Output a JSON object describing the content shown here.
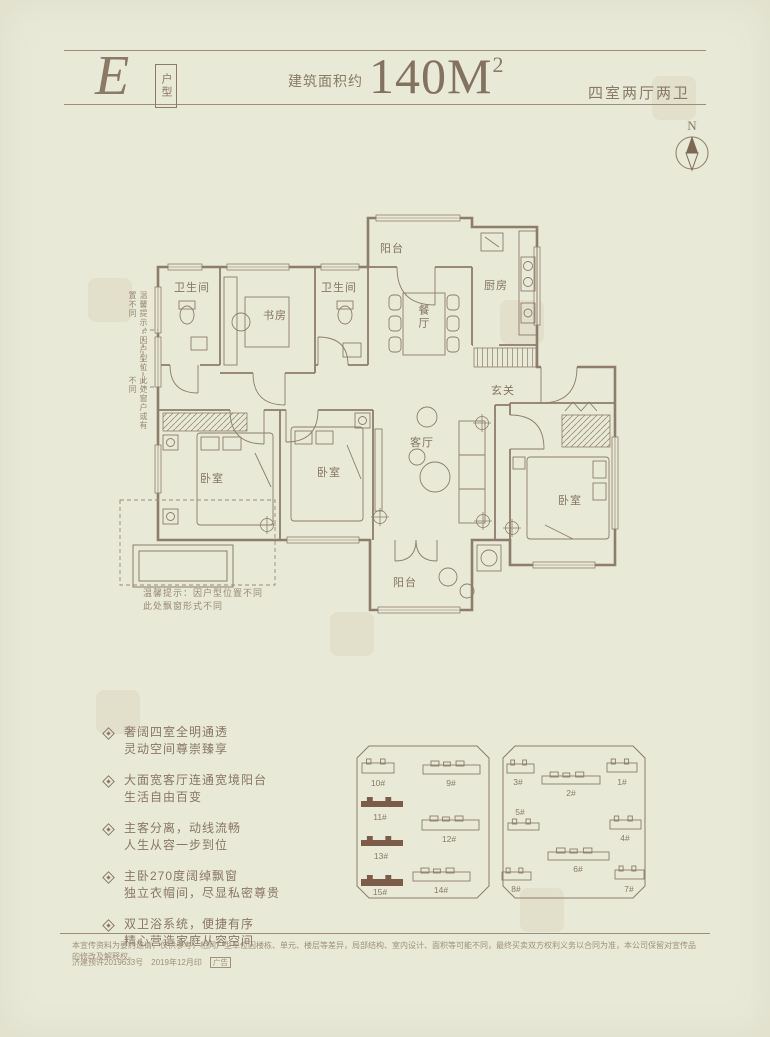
{
  "page": {
    "colors": {
      "background": "#e8e9d7",
      "ink": "#8a7a66",
      "wall": "#8d7d6a",
      "highlight_fill": "#7c5c49"
    }
  },
  "header": {
    "unit_letter": "E",
    "unit_label": "户型",
    "area_prefix": "建筑面积约",
    "area_number": "140M",
    "area_sup": "2",
    "spec": "四室两厅两卫",
    "compass_n": "N"
  },
  "floorplan": {
    "labels": {
      "bath1": "卫生间",
      "study": "书房",
      "bath2": "卫生间",
      "balcony_top": "阳台",
      "dining": "餐厅",
      "kitchen": "厨房",
      "foyer": "玄关",
      "living": "客厅",
      "bed1": "卧室",
      "bed2": "卧室",
      "bed3": "卧室",
      "balcony_bottom": "阳台"
    },
    "side_note_col1": "温馨提示：因户型位置不同",
    "side_note_col2": "此处窗户或有不同",
    "corner_note_line1": "温馨提示：因户型位置不同",
    "corner_note_line2": "此处飘窗形式不同"
  },
  "features": [
    {
      "line1": "奢阔四室全明通透",
      "line2": "灵动空间尊崇臻享"
    },
    {
      "line1": "大面宽客厅连通宽境阳台",
      "line2": "生活自由百变"
    },
    {
      "line1": "主客分离，动线流畅",
      "line2": "人生从容一步到位"
    },
    {
      "line1": "主卧270度阔绰飘窗",
      "line2": "独立衣帽间，尽显私密尊贵"
    },
    {
      "line1": "双卫浴系统，便捷有序",
      "line2": "精心营造家庭从容空间"
    }
  ],
  "siteplan": {
    "highlighted": [
      "11#",
      "13#",
      "15#"
    ],
    "left_block": {
      "outline": "M16 4 L124 4 L136 16 L136 144 L124 156 L16 156 L4 144 L4 16 Z",
      "buildings": [
        {
          "label": "10#",
          "x": 9,
          "y": 17,
          "w": 32,
          "h": 14,
          "filled": false,
          "lx": 25,
          "ly": 44
        },
        {
          "label": "9#",
          "x": 70,
          "y": 19,
          "w": 57,
          "h": 13,
          "filled": false,
          "lx": 98,
          "ly": 44
        },
        {
          "label": "11#",
          "x": 8,
          "y": 55,
          "w": 42,
          "h": 10,
          "filled": true,
          "lx": 27,
          "ly": 78
        },
        {
          "label": "12#",
          "x": 69,
          "y": 74,
          "w": 57,
          "h": 14,
          "filled": false,
          "lx": 96,
          "ly": 100
        },
        {
          "label": "13#",
          "x": 8,
          "y": 94,
          "w": 42,
          "h": 10,
          "filled": true,
          "lx": 28,
          "ly": 117
        },
        {
          "label": "14#",
          "x": 60,
          "y": 126,
          "w": 57,
          "h": 13,
          "filled": false,
          "lx": 88,
          "ly": 151
        },
        {
          "label": "15#",
          "x": 8,
          "y": 133,
          "w": 42,
          "h": 11,
          "filled": true,
          "lx": 27,
          "ly": 153
        }
      ]
    },
    "right_block": {
      "outline": "M18 4 H136 L148 16 V144 L136 156 H18 L6 144 V16 Z",
      "buildings": [
        {
          "label": "3#",
          "x": 10,
          "y": 18,
          "w": 27,
          "h": 13,
          "filled": false,
          "lx": 21,
          "ly": 43
        },
        {
          "label": "2#",
          "x": 45,
          "y": 30,
          "w": 58,
          "h": 12,
          "filled": false,
          "lx": 74,
          "ly": 54
        },
        {
          "label": "1#",
          "x": 110,
          "y": 17,
          "w": 30,
          "h": 13,
          "filled": false,
          "lx": 125,
          "ly": 43
        },
        {
          "label": "5#",
          "x": 11,
          "y": 77,
          "w": 31,
          "h": 11,
          "filled": false,
          "lx": 23,
          "ly": 73,
          "labelAbove": true
        },
        {
          "label": "4#",
          "x": 113,
          "y": 74,
          "w": 31,
          "h": 13,
          "filled": false,
          "lx": 128,
          "ly": 99
        },
        {
          "label": "6#",
          "x": 51,
          "y": 106,
          "w": 61,
          "h": 12,
          "filled": false,
          "lx": 81,
          "ly": 130
        },
        {
          "label": "8#",
          "x": 5,
          "y": 126,
          "w": 29,
          "h": 12,
          "filled": false,
          "lx": 19,
          "ly": 150
        },
        {
          "label": "7#",
          "x": 118,
          "y": 124,
          "w": 29,
          "h": 13,
          "filled": false,
          "lx": 132,
          "ly": 150
        }
      ]
    }
  },
  "footer": {
    "disclaimer": "本宣传资料为要约邀请，仅供参考，相同户型单位因楼栋、单元、楼层等差异，局部结构、室内设计、面积等可能不同，最终买卖双方权利义务以合同为准，本公司保留对宣传品的修改及解释权。",
    "permit": "济建预许2019633号",
    "print_date": "2019年12月印",
    "ad_label": "广告"
  }
}
